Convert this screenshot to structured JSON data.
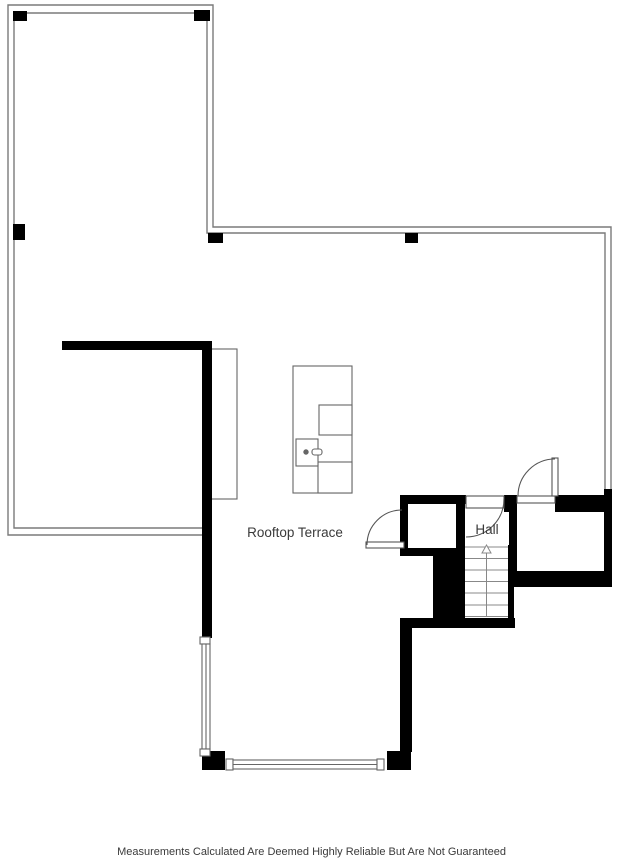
{
  "labels": {
    "terrace": "Rooftop Terrace",
    "hall": "Hall"
  },
  "disclaimer": "Measurements Calculated Are Deemed Highly Reliable But Are Not Guaranteed",
  "colors": {
    "wall": "#000000",
    "boundary_line": "#7a7a7a",
    "fixture_line": "#666666",
    "door_line": "#555555",
    "stair_line": "#888888",
    "text": "#3a3a3a",
    "floor": "#ffffff"
  }
}
